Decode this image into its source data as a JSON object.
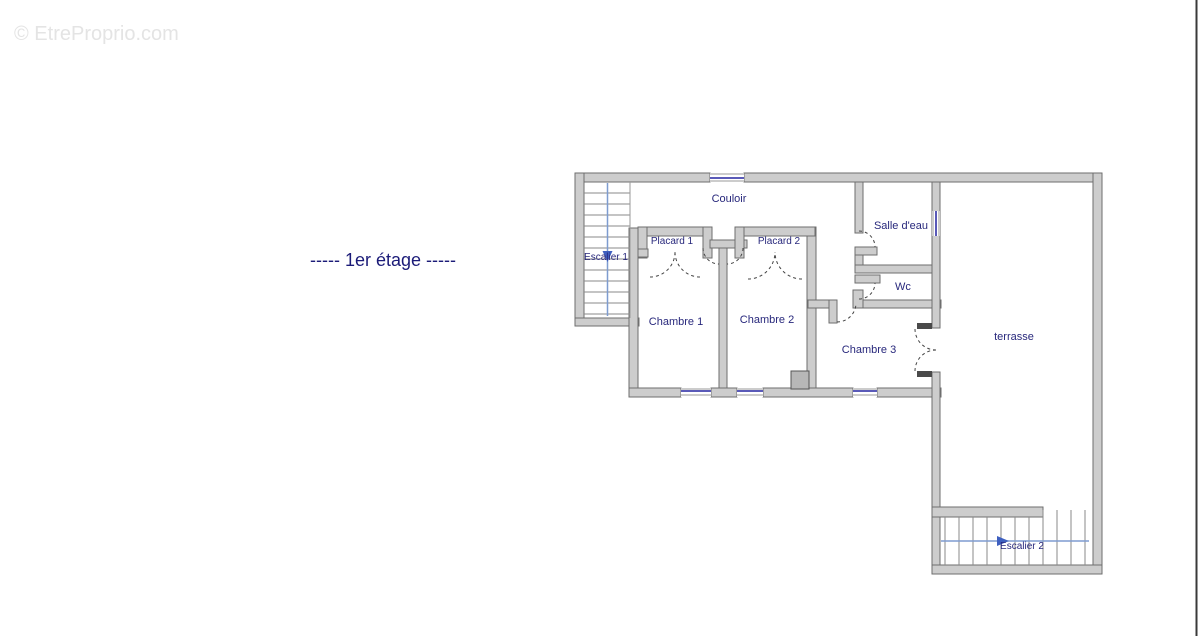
{
  "page": {
    "title": "-----  1er étage  -----",
    "watermark": "© EtreProprio.com"
  },
  "plan": {
    "rooms": {
      "couloir": {
        "label": "Couloir"
      },
      "escalier1": {
        "label": "Escalier 1"
      },
      "placard1": {
        "label": "Placard 1"
      },
      "placard2": {
        "label": "Placard 2"
      },
      "chambre1": {
        "label": "Chambre 1"
      },
      "chambre2": {
        "label": "Chambre 2"
      },
      "chambre3": {
        "label": "Chambre 3"
      },
      "salle_deau": {
        "label": "Salle d'eau"
      },
      "wc": {
        "label": "Wc"
      },
      "terrasse": {
        "label": "terrasse"
      },
      "escalier2": {
        "label": "Escalier 2"
      }
    }
  },
  "colors": {
    "wall_fill": "#cdcdcd",
    "wall_stroke": "#6e6e6e",
    "label_text": "#28287c",
    "title_text": "#1b1b78",
    "window_blue": "#5a5ab8",
    "stair_direction_blue": "#7e9cd0",
    "stair_arrow_blue": "#3e5fc0",
    "watermark_gray": "#e4e4e4"
  }
}
